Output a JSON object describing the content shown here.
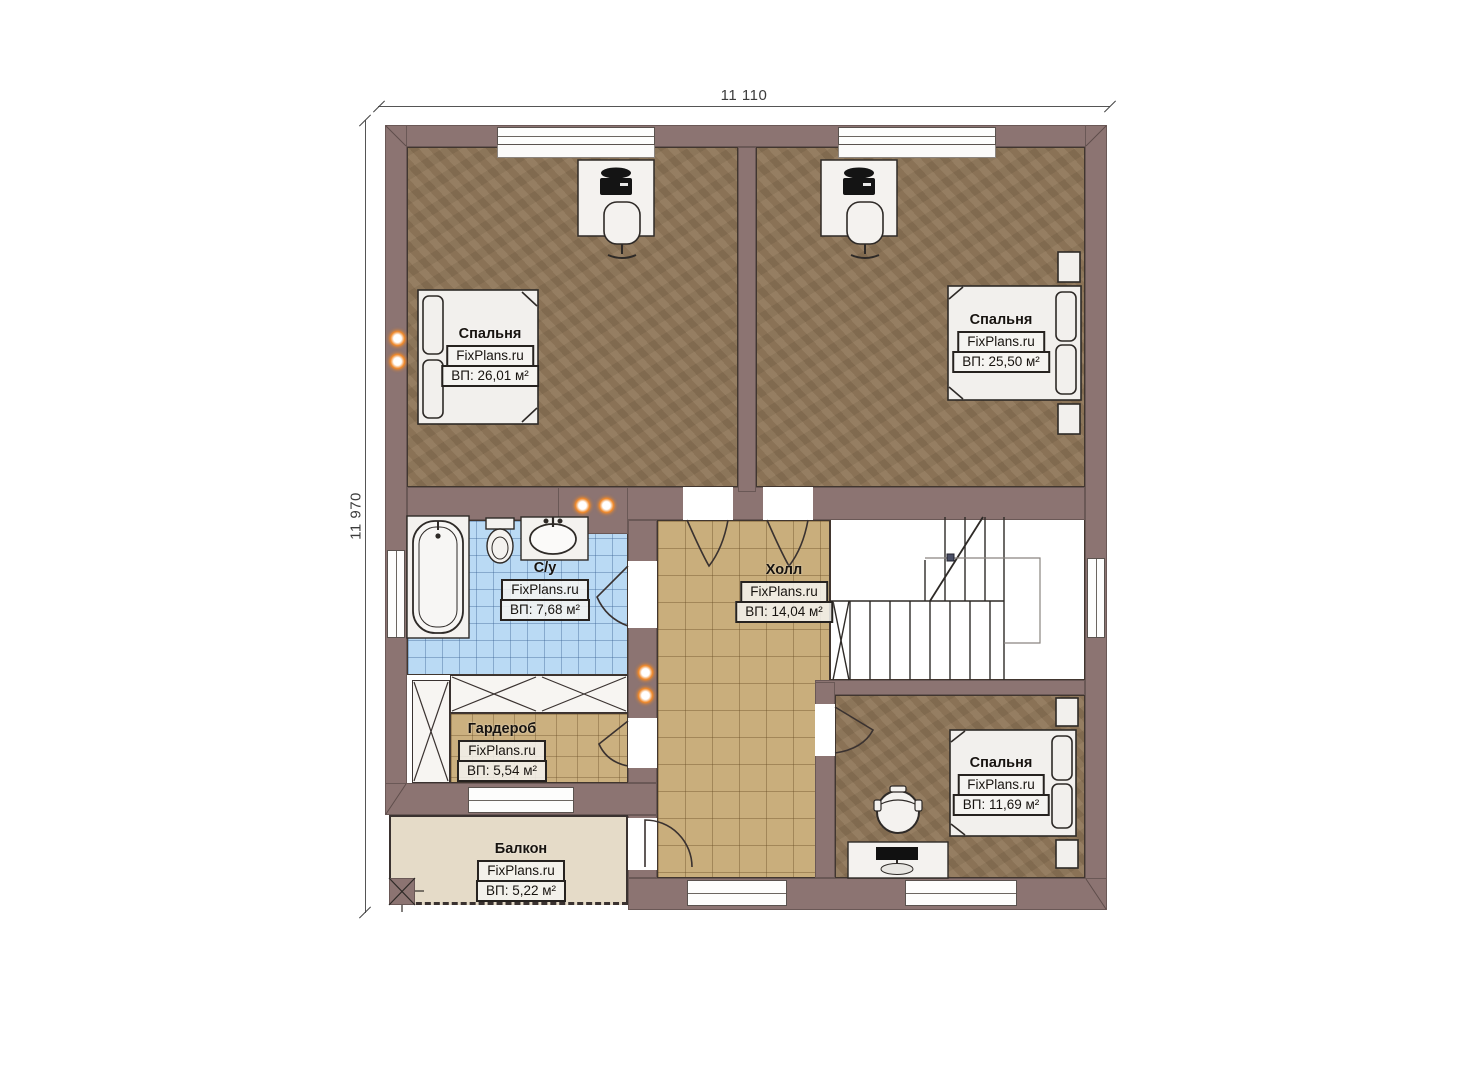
{
  "plan": {
    "source_brand": "FixPlans.ru",
    "type": "floor-plan-second-storey"
  },
  "dimensions": {
    "width_label": "11 110",
    "height_label": "11 970"
  },
  "rooms": [
    {
      "id": "bedroom-top-left",
      "name": "Спальня",
      "brand": "FixPlans.ru",
      "area": "ВП: 26,01 м²"
    },
    {
      "id": "bedroom-top-right",
      "name": "Спальня",
      "brand": "FixPlans.ru",
      "area": "ВП: 25,50 м²"
    },
    {
      "id": "bathroom",
      "name": "С/у",
      "brand": "FixPlans.ru",
      "area": "ВП: 7,68 м²"
    },
    {
      "id": "hall",
      "name": "Холл",
      "brand": "FixPlans.ru",
      "area": "ВП: 14,04 м²"
    },
    {
      "id": "wardrobe",
      "name": "Гардероб",
      "brand": "FixPlans.ru",
      "area": "ВП: 5,54 м²"
    },
    {
      "id": "bedroom-bottom",
      "name": "Спальня",
      "brand": "FixPlans.ru",
      "area": "ВП: 11,69 м²"
    },
    {
      "id": "balcony",
      "name": "Балкон",
      "brand": "FixPlans.ru",
      "area": "ВП: 5,22 м²"
    }
  ],
  "colors": {
    "wall": "#8c7472",
    "bedroom_floor": "#8d7456",
    "hall_tile": "#c9ae7c",
    "wardrobe_tile": "#cbb07f",
    "bathroom_tile": "#badaf4",
    "balcony_floor": "#e5dbc8",
    "stairs": "#ffffff",
    "furniture": "#f2f0ed",
    "light_accent": "#f08828",
    "outline": "#3a3230"
  }
}
